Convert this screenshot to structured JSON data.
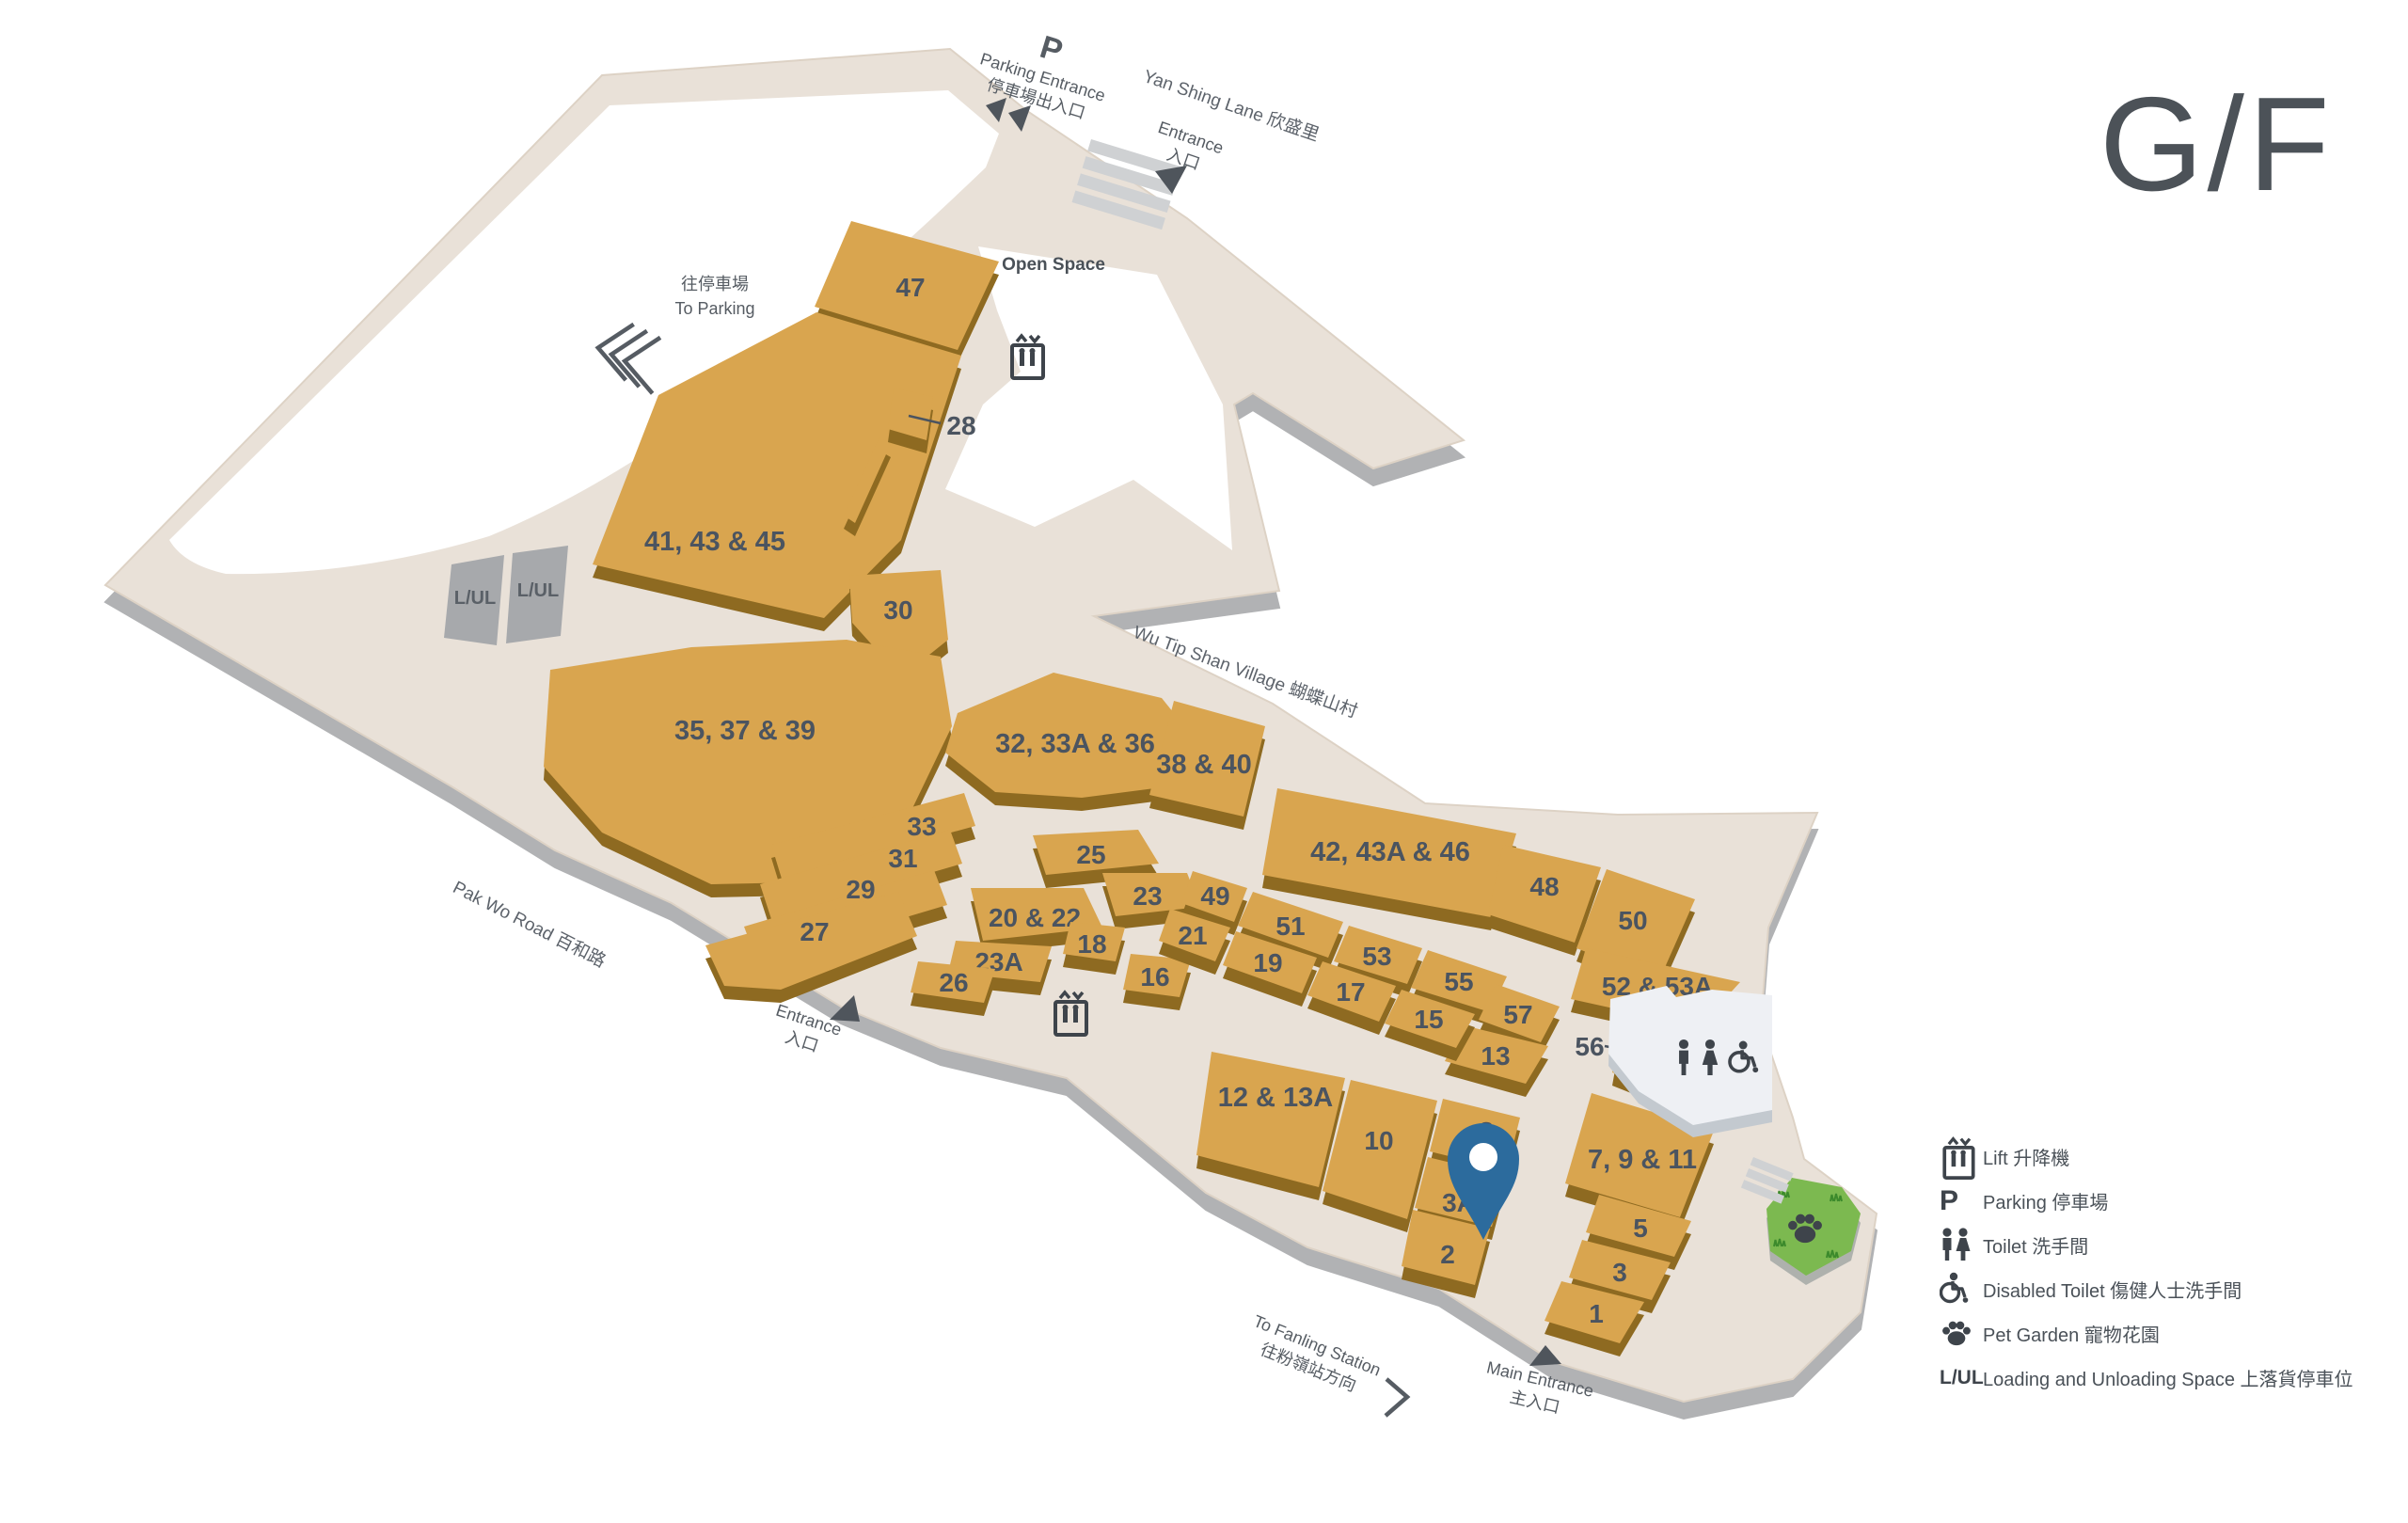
{
  "floor_title": "G/F",
  "areas": {
    "open_space": "Open Space",
    "loading_bay": "L/UL"
  },
  "roads": {
    "yan_shing_lane": "Yan Shing Lane 欣盛里",
    "wu_tip_shan_village": "Wu Tip Shan Village 蝴蝶山村",
    "pak_wo_road": "Pak Wo Road 百和路"
  },
  "wayfinding": {
    "parking_icon": "P",
    "parking_entrance_en": "Parking Entrance",
    "parking_entrance_zh": "停車場出入口",
    "to_parking_zh": "往停車場",
    "to_parking_en": "To Parking",
    "entrance_en": "Entrance",
    "entrance_zh": "入口",
    "main_entrance_en": "Main Entrance",
    "main_entrance_zh": "主入口",
    "to_fanling_en": "To Fanling Station",
    "to_fanling_zh": "往粉嶺站方向"
  },
  "shops": {
    "47": "47",
    "28": "28",
    "41_43_45": "41, 43 & 45",
    "30": "30",
    "35_37_39": "35, 37 & 39",
    "33": "33",
    "31": "31",
    "29": "29",
    "27": "27",
    "32_33A_36": "32, 33A & 36",
    "38_40": "38 & 40",
    "42_43A_46": "42, 43A & 46",
    "48": "48",
    "50": "50",
    "25": "25",
    "23": "23",
    "49": "49",
    "51": "51",
    "21": "21",
    "53": "53",
    "55": "55",
    "57": "57",
    "19": "19",
    "17": "17",
    "15": "15",
    "13": "13",
    "56": "56",
    "20_22": "20 & 22",
    "18": "18",
    "16": "16",
    "23A": "23A",
    "26": "26",
    "52_53A": "52 & 53A",
    "12_13A": "12 & 13A",
    "10": "10",
    "8": "8",
    "3A": "3A",
    "2": "2",
    "7_9_11": "7, 9 & 11",
    "5": "5",
    "3": "3",
    "1": "1"
  },
  "legend": [
    {
      "icon": "lift-icon",
      "label": "Lift 升降機"
    },
    {
      "icon": "parking-icon",
      "label": "Parking 停車場"
    },
    {
      "icon": "toilet-icon",
      "label": "Toilet 洗手間"
    },
    {
      "icon": "disabled-toilet-icon",
      "label": "Disabled Toilet 傷健人士洗手間"
    },
    {
      "icon": "pet-garden-icon",
      "label": "Pet Garden 寵物花園"
    },
    {
      "icon": "loading-unloading-icon",
      "label": "Loading and Unloading Space 上落貨停車位",
      "icon_text": "L/UL"
    }
  ]
}
